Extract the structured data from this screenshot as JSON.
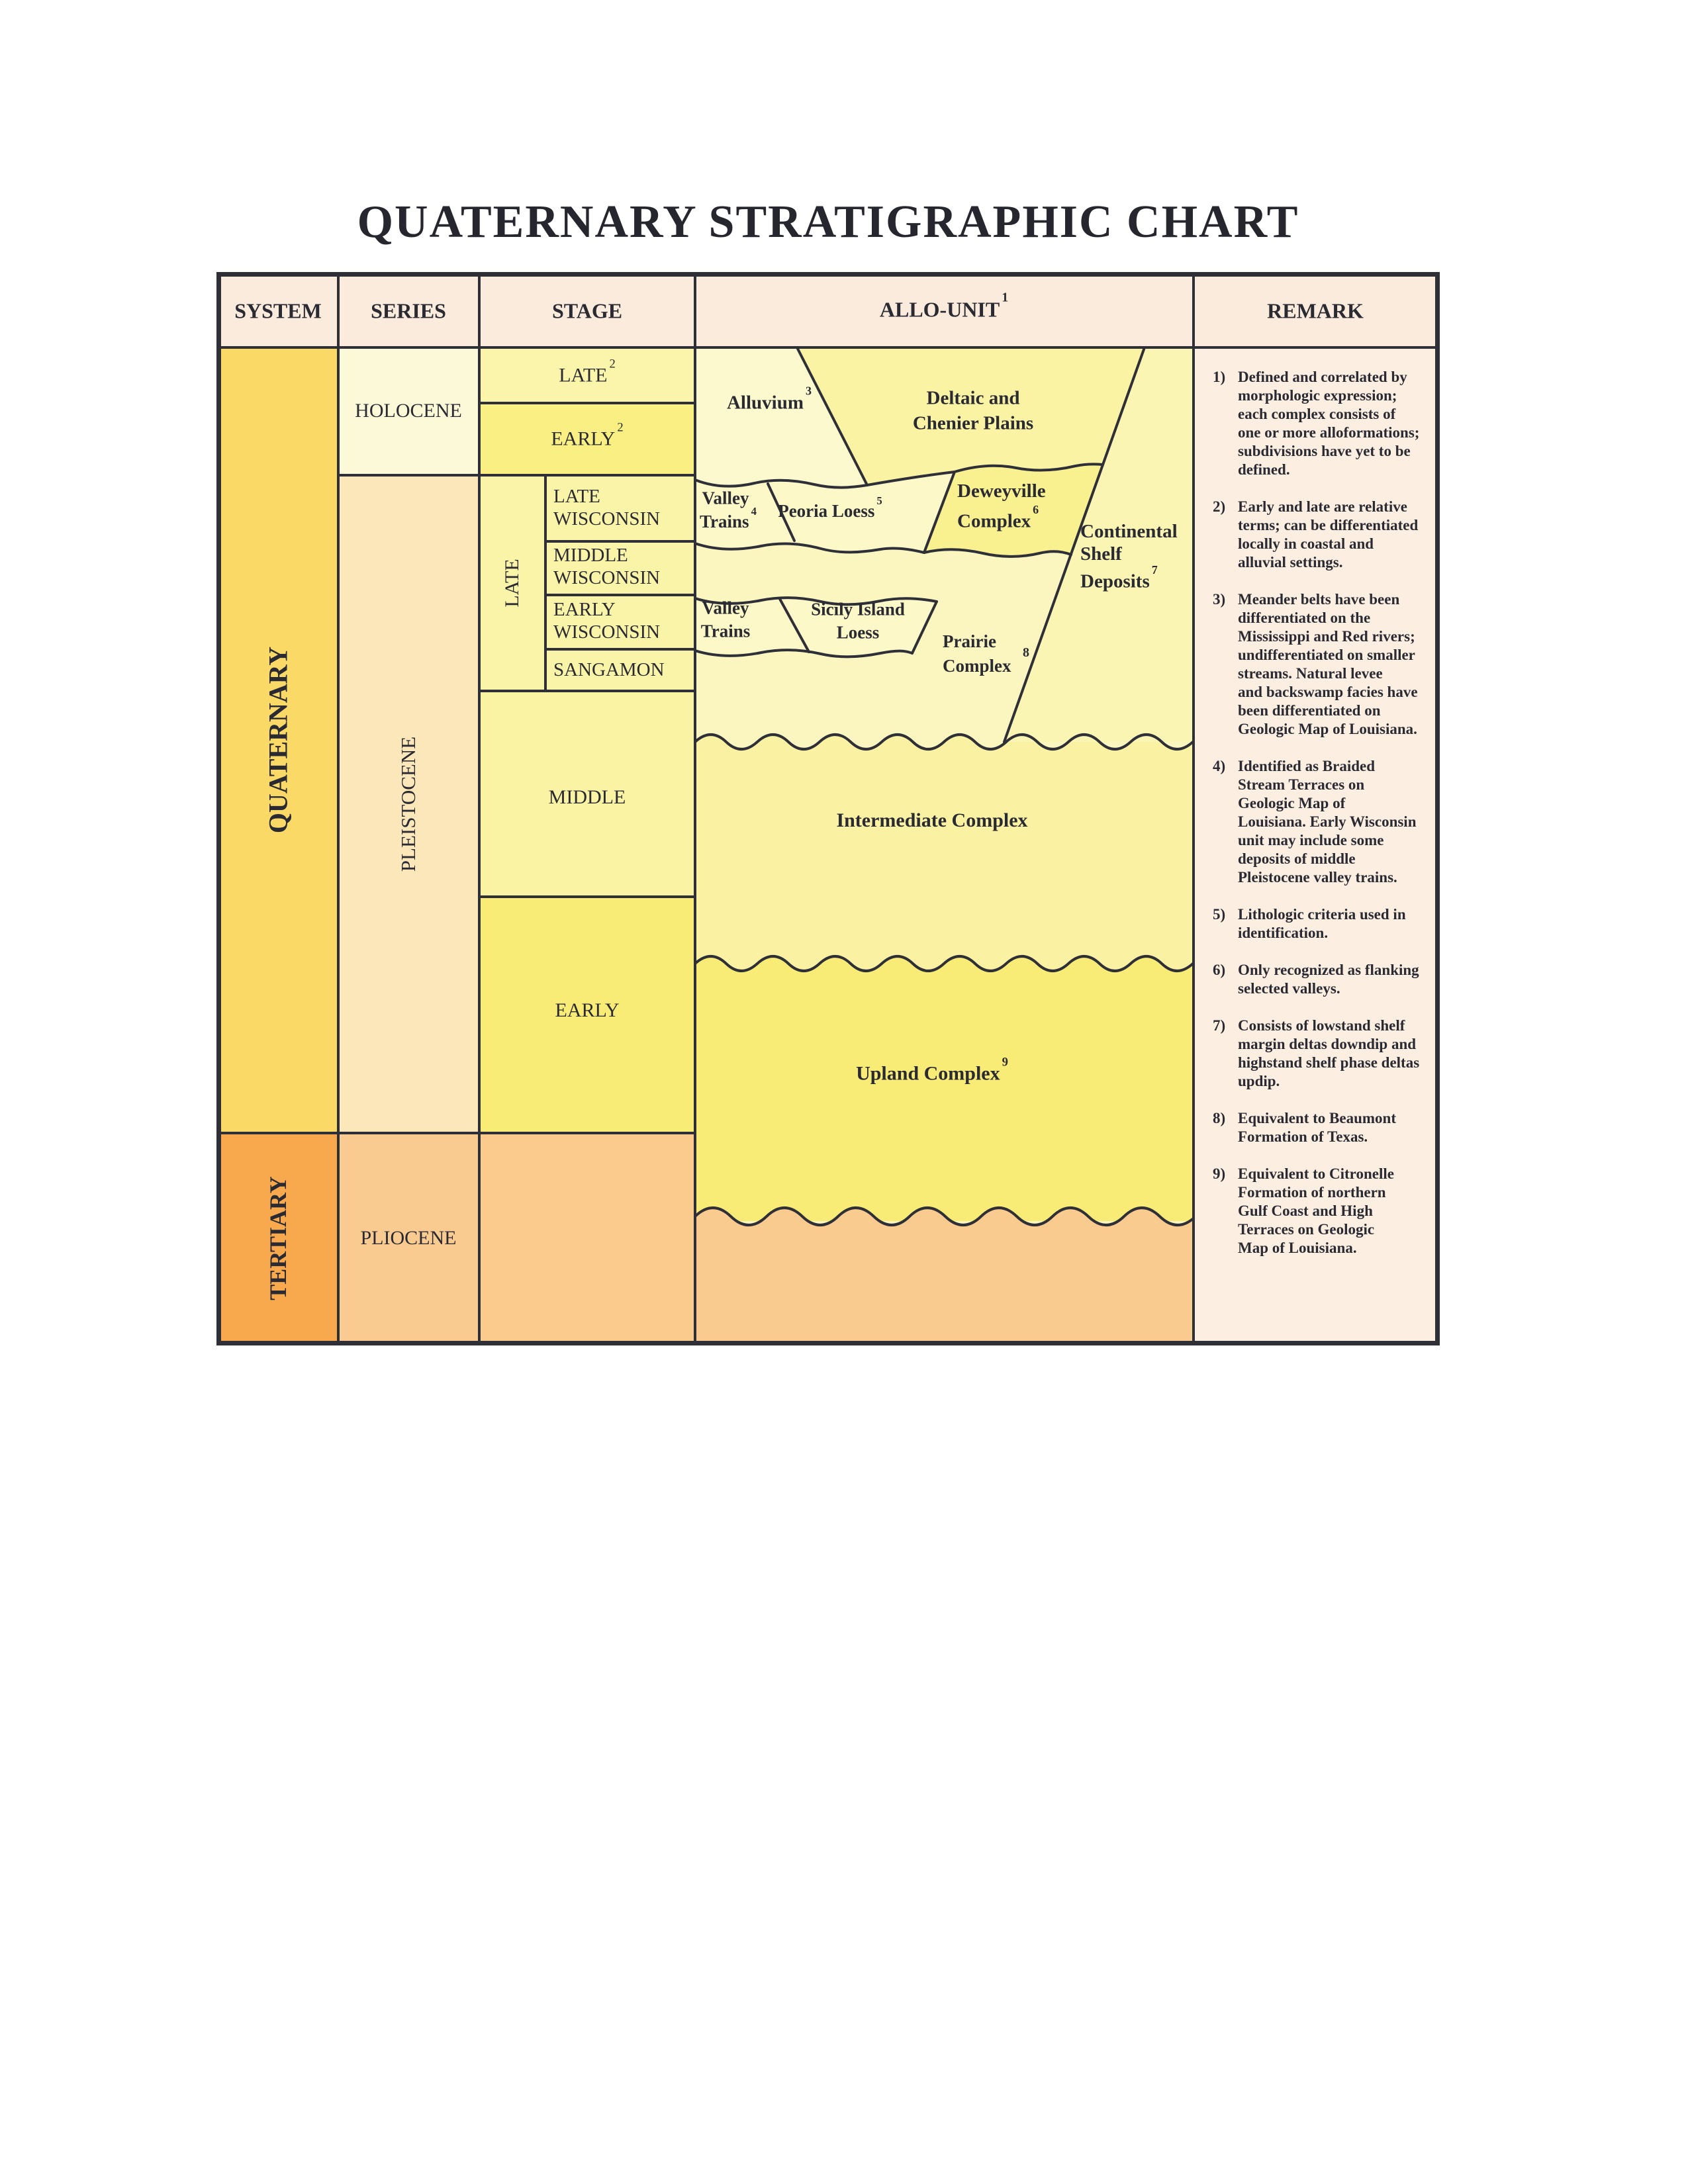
{
  "title": "QUATERNARY STRATIGRAPHIC CHART",
  "header": {
    "system": "SYSTEM",
    "series": "SERIES",
    "stage": "STAGE",
    "allo_unit": "ALLO-UNIT",
    "allo_unit_sup": "1",
    "remark": "REMARK"
  },
  "system": {
    "quaternary": "QUATERNARY",
    "tertiary": "TERTIARY"
  },
  "series": {
    "holocene": "HOLOCENE",
    "pleistocene": "PLEISTOCENE",
    "pliocene": "PLIOCENE"
  },
  "stage": {
    "late_holocene": "LATE",
    "late_holocene_sup": "2",
    "early_holocene": "EARLY",
    "early_holocene_sup": "2",
    "late_group": "LATE",
    "late_wisconsin_1": "LATE",
    "late_wisconsin_2": "WISCONSIN",
    "middle_wisconsin_1": "MIDDLE",
    "middle_wisconsin_2": "WISCONSIN",
    "early_wisconsin_1": "EARLY",
    "early_wisconsin_2": "WISCONSIN",
    "sangamon": "SANGAMON",
    "middle": "MIDDLE",
    "early": "EARLY"
  },
  "allo_units": {
    "alluvium": {
      "label": "Alluvium",
      "sup": "3"
    },
    "deltaic": {
      "line1": "Deltaic and",
      "line2": "Chenier Plains"
    },
    "valley_trains_late": {
      "line1": "Valley",
      "line2": "Trains",
      "sup": "4"
    },
    "peoria_loess": {
      "label": "Peoria Loess",
      "sup": "5"
    },
    "deweyville": {
      "line1": "Deweyville",
      "line2": "Complex",
      "sup": "6"
    },
    "continental_shelf": {
      "line1": "Continental",
      "line2": "Shelf",
      "line3": "Deposits",
      "sup": "7"
    },
    "valley_trains_early": {
      "line1": "Valley",
      "line2": "Trains"
    },
    "sicily_island": {
      "line1": "Sicily Island",
      "line2": "Loess"
    },
    "prairie": {
      "line1": "Prairie",
      "line2": "Complex",
      "sup": "8"
    },
    "intermediate": {
      "label": "Intermediate Complex"
    },
    "upland": {
      "label": "Upland Complex",
      "sup": "9"
    }
  },
  "remarks": [
    {
      "num": "1)",
      "lines": [
        "Defined and correlated by",
        "morphologic expression;",
        "each complex consists of",
        "one or more alloformations;",
        "subdivisions have yet to be",
        "defined."
      ]
    },
    {
      "num": "2)",
      "lines": [
        "Early and late are relative",
        "terms; can be differentiated",
        "locally in coastal and",
        "alluvial settings."
      ]
    },
    {
      "num": "3)",
      "lines": [
        "Meander belts have been",
        "differentiated on the",
        "Mississippi and Red rivers;",
        "undifferentiated on smaller",
        "streams. Natural levee",
        "and backswamp facies have",
        "been differentiated on",
        "Geologic Map of Louisiana."
      ]
    },
    {
      "num": "4)",
      "lines": [
        "Identified as Braided",
        "Stream Terraces on",
        "Geologic Map of",
        "Louisiana. Early Wisconsin",
        "unit may include some",
        "deposits of middle",
        "Pleistocene valley trains."
      ]
    },
    {
      "num": "5)",
      "lines": [
        "Lithologic criteria used in",
        "identification."
      ]
    },
    {
      "num": "6)",
      "lines": [
        "Only recognized as flanking",
        "selected valleys."
      ]
    },
    {
      "num": "7)",
      "lines": [
        "Consists of lowstand shelf",
        "margin deltas downdip and",
        "highstand shelf phase deltas",
        "updip."
      ]
    },
    {
      "num": "8)",
      "lines": [
        "Equivalent to Beaumont",
        "Formation of Texas."
      ]
    },
    {
      "num": "9)",
      "lines": [
        "Equivalent to Citronelle",
        "Formation of northern",
        "Gulf Coast and High",
        "Terraces on Geologic",
        "Map of Louisiana."
      ]
    }
  ],
  "colors": {
    "border": "#2F2F38",
    "header_bg": "#FBEBDC",
    "remark_bg": "#FCEFE2",
    "quaternary": "#FBD967",
    "tertiary": "#F8A94E",
    "holocene": "#FCF9D8",
    "pleistocene": "#FCE7BA",
    "pliocene": "#FACB90",
    "late_holocene_cell": "#FBF5AC",
    "early_holocene_cell": "#F9EF83",
    "wisconsin_cells": "#FAF4A8",
    "middle_cell": "#FAF3A4",
    "early_cell": "#F8EC76",
    "alluvium": "#FCF9CE",
    "deltaic": "#FAF3A3",
    "loess_bands": "#FCF8C8",
    "deweyville": "#F9F090",
    "shelf_strip": "#FBF5B4",
    "open_region": "#FBF6C0",
    "intermediate": "#FAF2A2",
    "upland": "#F8EC76",
    "pliocene_allo": "#FACB8E"
  }
}
